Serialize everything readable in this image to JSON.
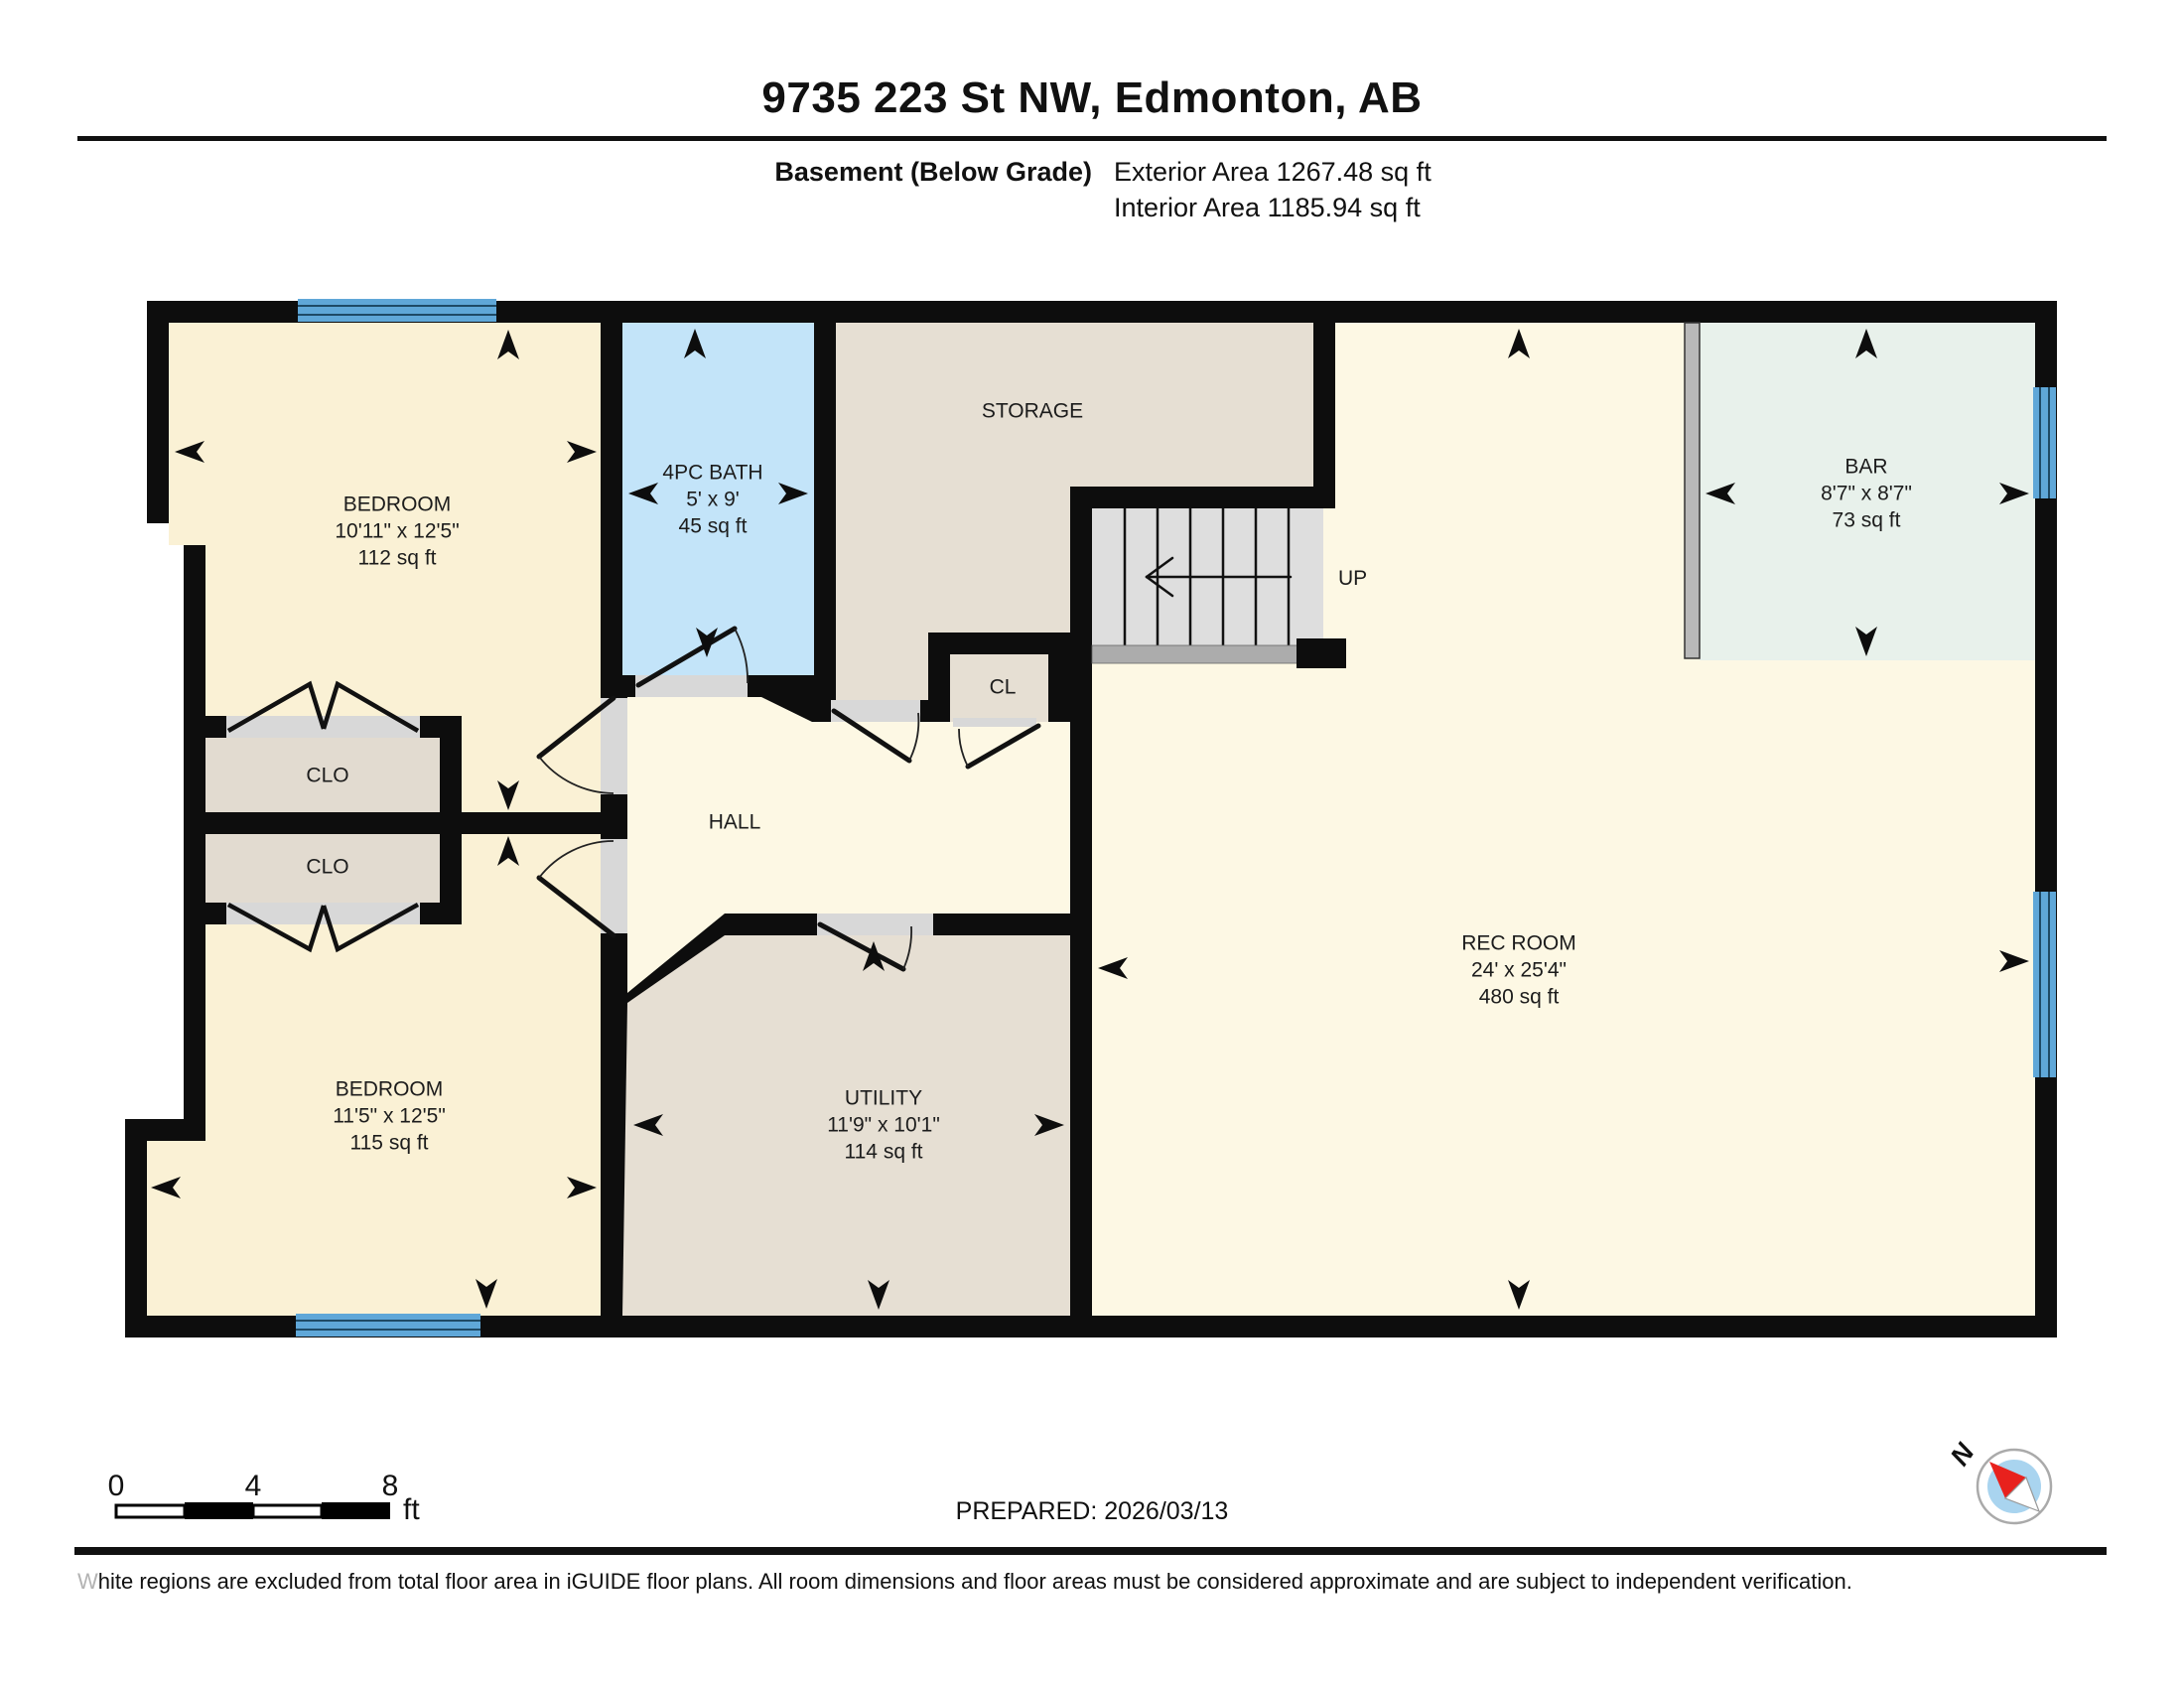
{
  "header": {
    "title": "9735 223 St NW, Edmonton, AB",
    "floor_label": "Basement (Below Grade)",
    "exterior_area": "Exterior Area 1267.48 sq ft",
    "interior_area": "Interior Area 1185.94 sq ft"
  },
  "rooms": {
    "bedroom1": {
      "name": "BEDROOM",
      "dims": "10'11\" x 12'5\"",
      "area": "112 sq ft"
    },
    "bath": {
      "name": "4PC BATH",
      "dims": "5' x 9'",
      "area": "45 sq ft"
    },
    "storage": {
      "name": "STORAGE"
    },
    "bar": {
      "name": "BAR",
      "dims": "8'7\" x 8'7\"",
      "area": "73 sq ft"
    },
    "closet1": {
      "name": "CLO"
    },
    "closet2": {
      "name": "CLO"
    },
    "hall": {
      "name": "HALL"
    },
    "cl": {
      "name": "CL"
    },
    "stairs": {
      "name": "UP"
    },
    "rec": {
      "name": "REC ROOM",
      "dims": "24' x 25'4\"",
      "area": "480 sq ft"
    },
    "bedroom2": {
      "name": "BEDROOM",
      "dims": "11'5\" x 12'5\"",
      "area": "115 sq ft"
    },
    "utility": {
      "name": "UTILITY",
      "dims": "11'9\" x 10'1\"",
      "area": "114 sq ft"
    }
  },
  "footer": {
    "scale_ticks": [
      "0",
      "4",
      "8"
    ],
    "scale_unit": "ft",
    "prepared": "PREPARED: 2026/03/13",
    "compass_north": "N",
    "disclaimer": "White regions are excluded from total floor area in iGUIDE floor plans. All room dimensions and floor areas must be considered approximate and are subject to independent verification."
  },
  "colors": {
    "wall": "#0d0d0d",
    "bedroom_fill": "#FAF1D5",
    "rec_hall_fill": "#FDF8E4",
    "bath_fill": "#C3E4F9",
    "storage_fill": "#E6DFD3",
    "closet_fill": "#E2DBD0",
    "bar_fill": "#E8F1EB",
    "window_blue": "#5FA7D8",
    "stairs_gray": "#DEDEDE",
    "compass_red": "#E8211D"
  }
}
